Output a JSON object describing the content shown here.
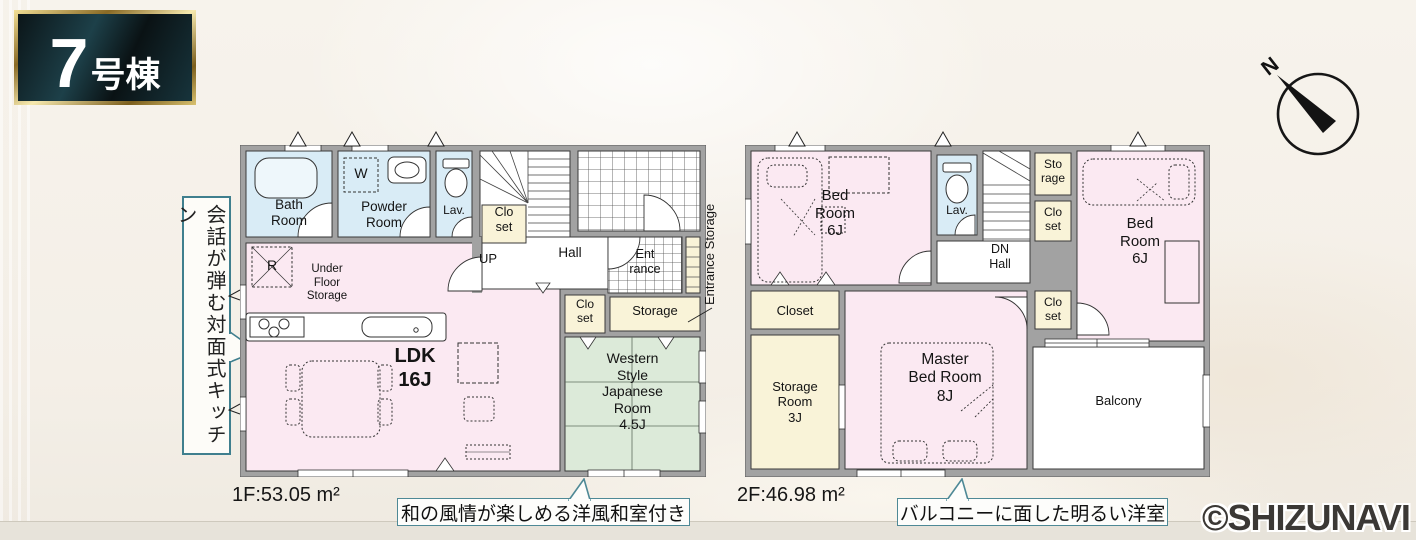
{
  "badge": {
    "number": "7",
    "suffix": "号棟"
  },
  "compass": {
    "north": "N"
  },
  "callout_kitchen": "会話が弾む対面式キッチン",
  "floor1": {
    "area": "1F:53.05 m²",
    "caption": "和の風情が楽しめる洋風和室付き",
    "side_label": "Entrance Storage",
    "labels": {
      "bath": "Bath\nRoom",
      "powder": "Powder\nRoom",
      "lav": "Lav.",
      "washer": "W",
      "closet_stairs": "Clo\nset",
      "up": "UP",
      "hall": "Hall",
      "entrance": "Ent\nrance",
      "fridge": "R",
      "under_floor": "Under\nFloor\nStorage",
      "ldk": "LDK\n16J",
      "closet_mid": "Clo\nset",
      "storage": "Storage",
      "japanese": "Western\nStyle\nJapanese\nRoom\n4.5J"
    }
  },
  "floor2": {
    "area": "2F:46.98 m²",
    "caption": "バルコニーに面した明るい洋室",
    "labels": {
      "bedroom_left": "Bed\nRoom\n6J",
      "lav": "Lav.",
      "dn_hall": "DN\nHall",
      "storage_top": "Sto\nrage",
      "closet_top": "Clo\nset",
      "closet_mid": "Clo\nset",
      "bedroom_right": "Bed\nRoom\n6J",
      "closet_left": "Closet",
      "storage_room": "Storage\nRoom\n3J",
      "master": "Master\nBed Room\n8J",
      "balcony": "Balcony"
    }
  },
  "copyright": "©SHIZUNAVI",
  "colors": {
    "accent_teal": "#3f7f8e",
    "wall_gray": "#a2a2a2",
    "room_pink": "#fbe9f2",
    "room_blue": "#d9ecf6",
    "room_yellow": "#f9f3d8",
    "room_green": "#dcead9",
    "badge_gold": "#cdb06a",
    "badge_bg": "#12282e"
  }
}
